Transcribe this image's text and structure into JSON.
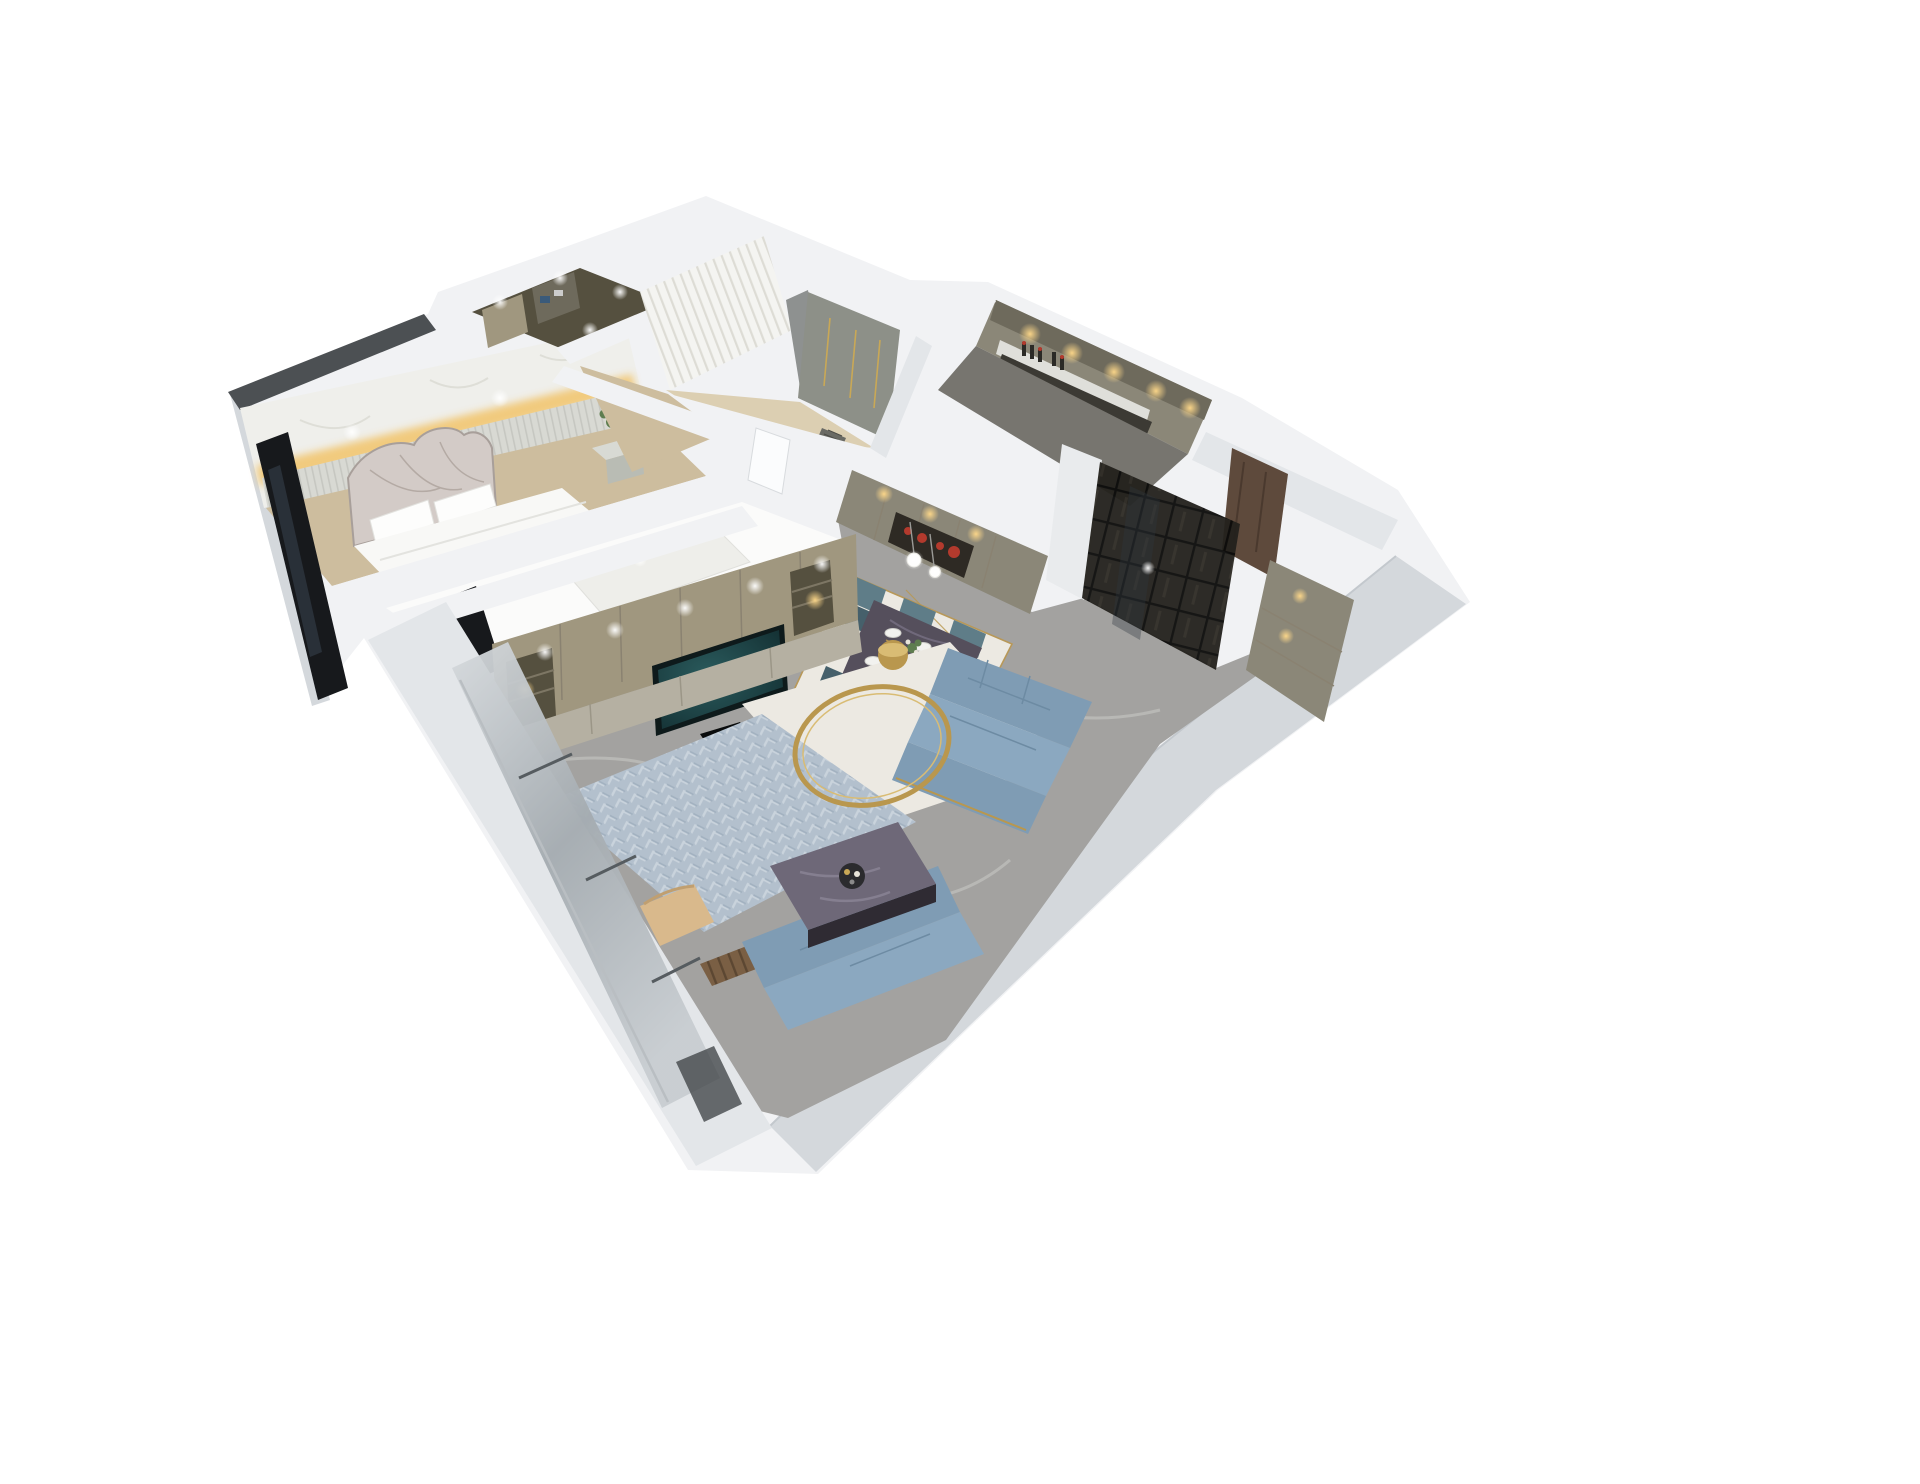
{
  "tv": {
    "brand": "S K Y D A N C E",
    "sub": "P R O D U C T I O N S"
  },
  "colors": {
    "bg": "#ffffff",
    "wallTop": "#f1f2f4",
    "wallFace": "#e3e6e9",
    "wallShade": "#d4d8dc",
    "roofDark": "#4c5053",
    "glassDark": "#17191c",
    "glassStreak": "#2e3640",
    "marbleWall": "#efefeb",
    "ledGlow": "#f2c162",
    "stripeWall": "#d8d9d3",
    "floorMarble": "#a3a2a0",
    "floorVein": "#cbcac6",
    "floorWood": "#cdbd9e",
    "floorWoodLight": "#dccfb2",
    "cabinetTaupe": "#a0977f",
    "cabinetDark": "#55503f",
    "cabinetOlive": "#8b8778",
    "cabinetGreen": "#8d9088",
    "cabinetDeep": "#6e6a5c",
    "mediaBase": "#b5b0a2",
    "tvBezel": "#0e1a1b",
    "tvScreen": "#1b4044",
    "tvText": "#e8ecec",
    "sofaBlue": "#7f9cb4",
    "sofaBlueLight": "#8ba8c0",
    "rugWhite": "#ece9e2",
    "rugBlue": "#b3c0cd",
    "rugPattern": "#c9d3dc",
    "gold": "#b9974e",
    "goldLight": "#d9bc74",
    "tableMarble": "#554f5c",
    "tableVein": "#7c7589",
    "tableEdge": "#2f2b33",
    "chairTeal": "#5f7d88",
    "chairTealDark": "#46606b",
    "beige": "#d9b98c",
    "bedHead": "#d3cbc7",
    "bedHeadLine": "#a89f9a",
    "bedWhite": "#f8f8f6",
    "pillow": "#fdfdfc",
    "plantGreen": "#5e7d4f",
    "nightstand": "#d8dad4",
    "nightstandFace": "#b9bcb4",
    "doorBrown": "#5e4a3c",
    "red": "#b33a2d",
    "nicheDark": "#2e2a24",
    "counterDark": "#3c3a34",
    "curtain": "#f4f4f1",
    "curtainLine": "#dddcd5",
    "drapeGrey": "#8e9190",
    "kitchenFloor": "#77756f",
    "brightRoom": "#fbfbfa",
    "bedFaint": "#eeeeea",
    "warmGlow": "#f0b860",
    "woodSlat": "#7a5f44",
    "seam": "#8a8271",
    "glassFrame": "#5b6165"
  }
}
